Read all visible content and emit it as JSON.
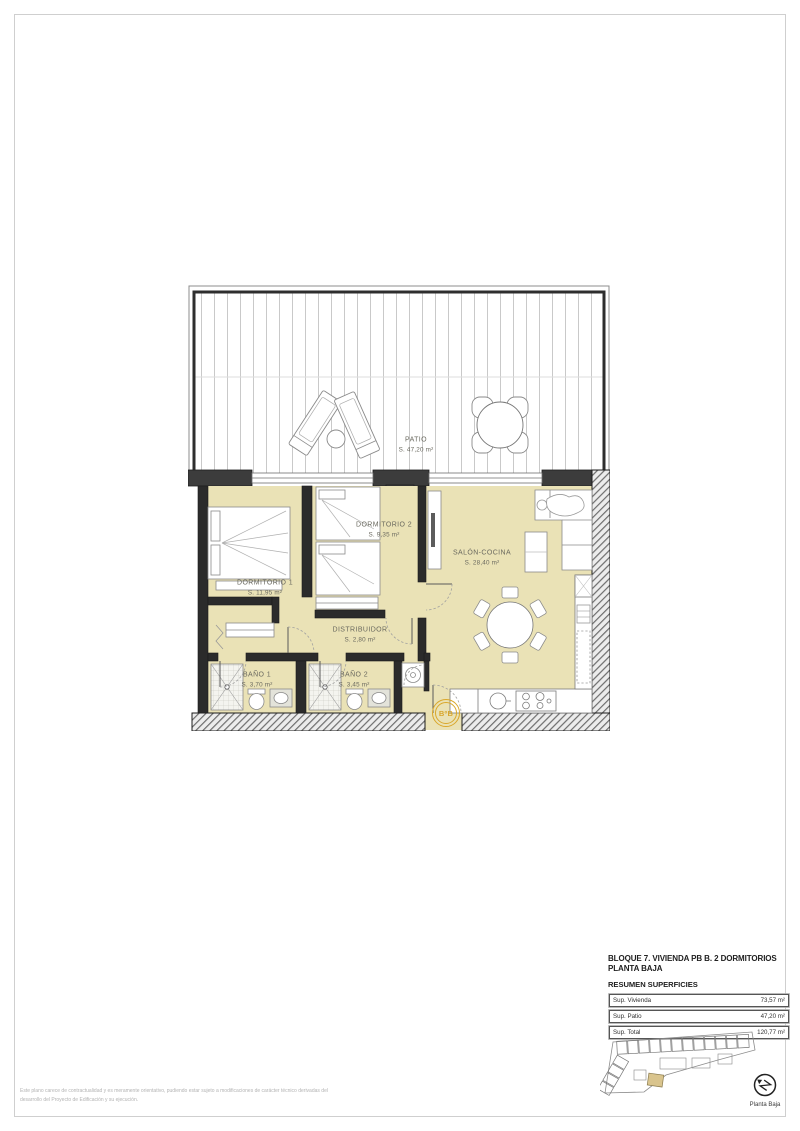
{
  "colors": {
    "room_fill": "#eae2b6",
    "wall_dark": "#2b2b2b",
    "entrance_accent": "#d9a72b",
    "keyplan_highlight": "#d9c48d",
    "sheet_frame": "#cfcfcf"
  },
  "plan": {
    "entrance_label": "BºB",
    "rooms": [
      {
        "name": "PATIO",
        "area": "S. 47,20 m²"
      },
      {
        "name": "DORMITORIO 1",
        "area": "S. 11,95 m²"
      },
      {
        "name": "DORMITORIO 2",
        "area": "S. 9,35 m²"
      },
      {
        "name": "SALÓN-COCINA",
        "area": "S. 28,40 m²"
      },
      {
        "name": "DISTRIBUIDOR",
        "area": "S. 2,80 m²"
      },
      {
        "name": "BAÑO 1",
        "area": "S. 3,70 m²"
      },
      {
        "name": "BAÑO 2",
        "area": "S. 3,45 m²"
      }
    ]
  },
  "title_block": {
    "line1": "BLOQUE 7. VIVIENDA PB B. 2 DORMITORIOS",
    "line2": "PLANTA BAJA",
    "subtitle": "RESUMEN SUPERFICIES",
    "table": {
      "rows": [
        {
          "label": "Sup. Vivienda",
          "value": "73,57 m²"
        },
        {
          "label": "Sup. Patio",
          "value": "47,20 m²"
        },
        {
          "label": "Sup. Total",
          "value": "120,77 m²"
        }
      ]
    },
    "key_plan_caption": "Planta Baja"
  },
  "footer": {
    "disclaimer_line1": "Este plano carece de contractualidad y es meramente orientativo, pudiendo estar sujeto a modificaciones de carácter técnico derivadas del",
    "disclaimer_line2": "desarrollo del Proyecto de Edificación y su ejecución."
  }
}
